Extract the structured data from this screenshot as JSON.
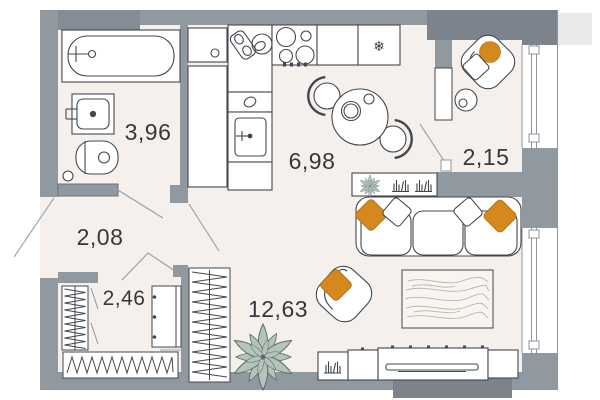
{
  "plan_type": "apartment-floor-plan",
  "rooms": {
    "bathroom": {
      "area": "3,96"
    },
    "kitchen": {
      "area": "6,98"
    },
    "balcony": {
      "area": "2,15"
    },
    "hallway": {
      "area": "2,08"
    },
    "closet": {
      "area": "2,46"
    },
    "living_room": {
      "area": "12,63"
    }
  },
  "colors": {
    "wall": "#9098A0",
    "wall_thick": "#858C95",
    "wall_dark": "#7C838C",
    "floor": "#F5F0EB",
    "outline": "#43484E",
    "accent_orange": "#D4881E",
    "plant_green": "#B4C3BC",
    "plant_outline": "#5D6D65",
    "door_line": "#969DA5"
  },
  "icons": [
    "bathtub-icon",
    "bathroom-sink-icon",
    "toilet-icon",
    "storage-cabinet-icon",
    "hob-icon",
    "kitchen-sink-icon",
    "fridge-snowflake-icon",
    "dining-table-icon",
    "chair-icon",
    "balcony-armchair-icon",
    "side-table-icon",
    "sofa-icon",
    "pillow-icon",
    "lounge-armchair-icon",
    "rug-icon",
    "tv-console-icon",
    "tv-icon",
    "books-icon",
    "shelf-plant-icon",
    "floor-plant-icon",
    "wardrobe-icon",
    "closet-rail-icon",
    "shoe-rack-icon",
    "dresser-icon",
    "window-icon",
    "door-swing-icon"
  ]
}
